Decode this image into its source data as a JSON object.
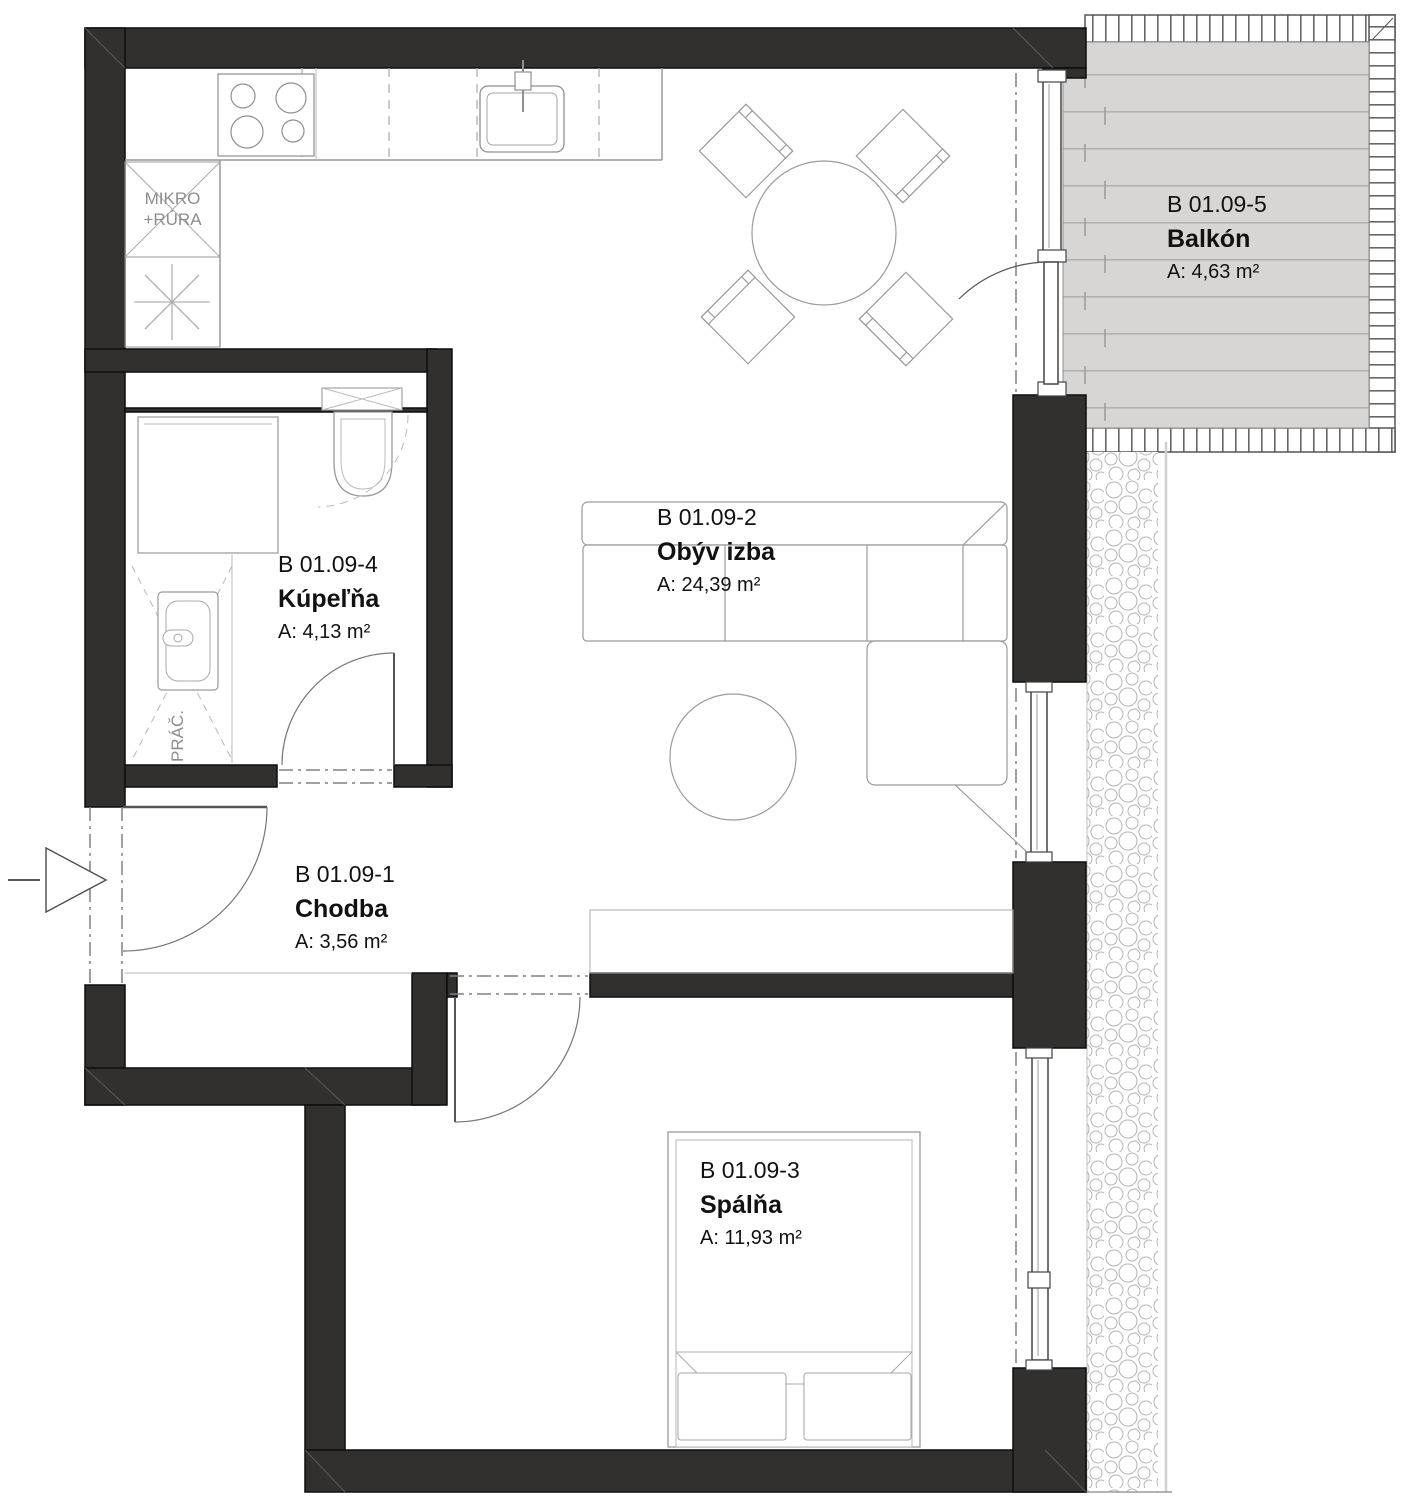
{
  "plan": {
    "title": "Apartment B 01.09 floor plan",
    "rooms": {
      "chodba": {
        "id": "B 01.09-1",
        "name": "Chodba",
        "area": "A: 3,56 m²"
      },
      "obyv": {
        "id": "B 01.09-2",
        "name": "Obýv izba",
        "area": "A: 24,39 m²"
      },
      "spalna": {
        "id": "B 01.09-3",
        "name": "Spálňa",
        "area": "A: 11,93 m²"
      },
      "kupelna": {
        "id": "B 01.09-4",
        "name": "Kúpeľňa",
        "area": "A: 4,13 m²"
      },
      "balkon": {
        "id": "B 01.09-5",
        "name": "Balkón",
        "area": "A: 4,63 m²"
      }
    },
    "annotations": {
      "mikro_line1": "MIKRO",
      "mikro_line2": "+RÚRA",
      "prac": "PRÁČ."
    },
    "colors": {
      "wall": "#31302f",
      "thin_line": "#999999",
      "deck": "#d7d6d5",
      "label_text": "#111111",
      "annotation_text": "#8d8d8d"
    }
  }
}
